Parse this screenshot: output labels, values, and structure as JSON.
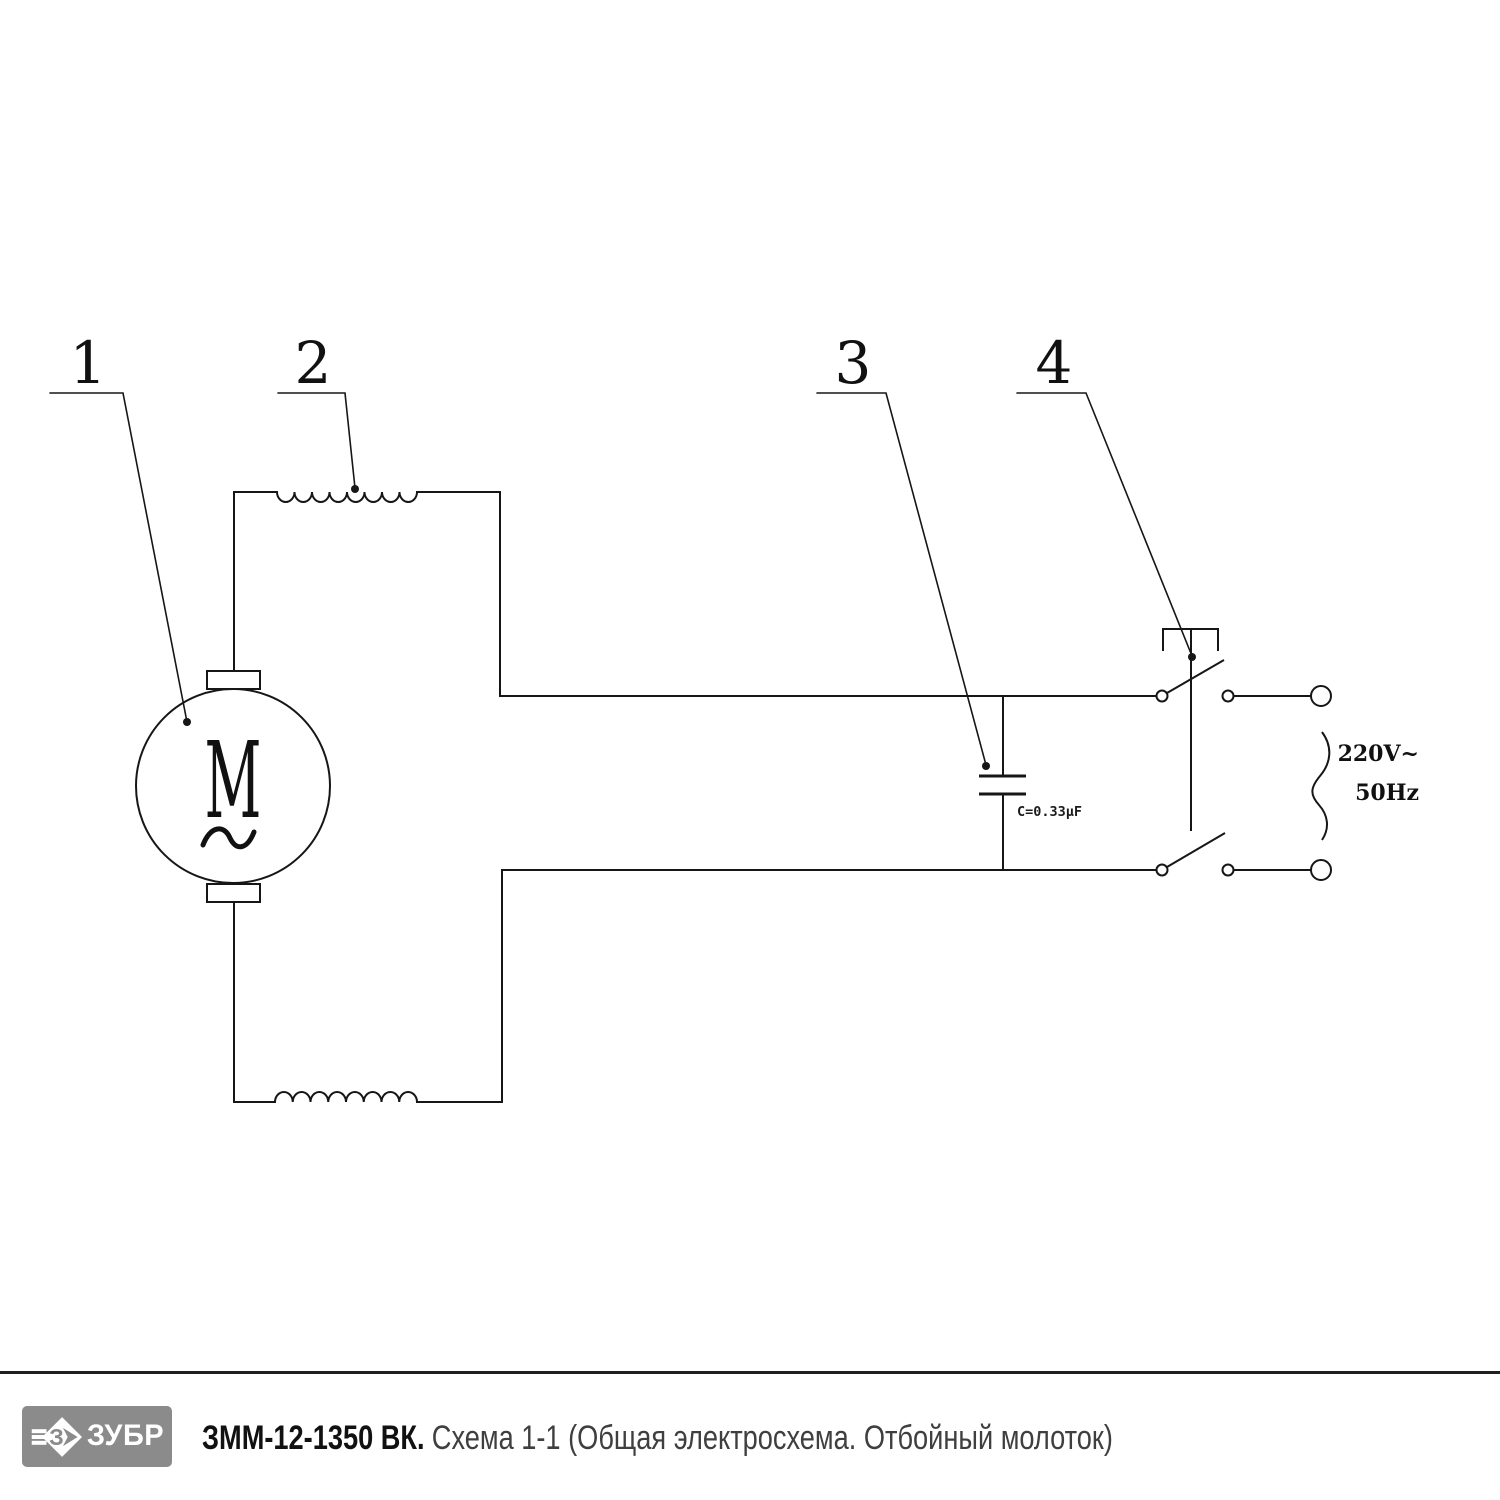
{
  "schematic": {
    "callout_labels": [
      "1",
      "2",
      "3",
      "4"
    ],
    "motor_symbol": "M",
    "capacitor_value": "C=0.33µF",
    "supply_voltage": "220V~",
    "supply_frequency": "50Hz",
    "line_color": "#161616"
  },
  "footer": {
    "brand": "ЗУБР",
    "logo_bg": "#8b8b8b",
    "model": "ЗММ-12-1350 ВК.",
    "caption": "Схема 1-1 (Общая электросхема. Отбойный молоток)"
  }
}
